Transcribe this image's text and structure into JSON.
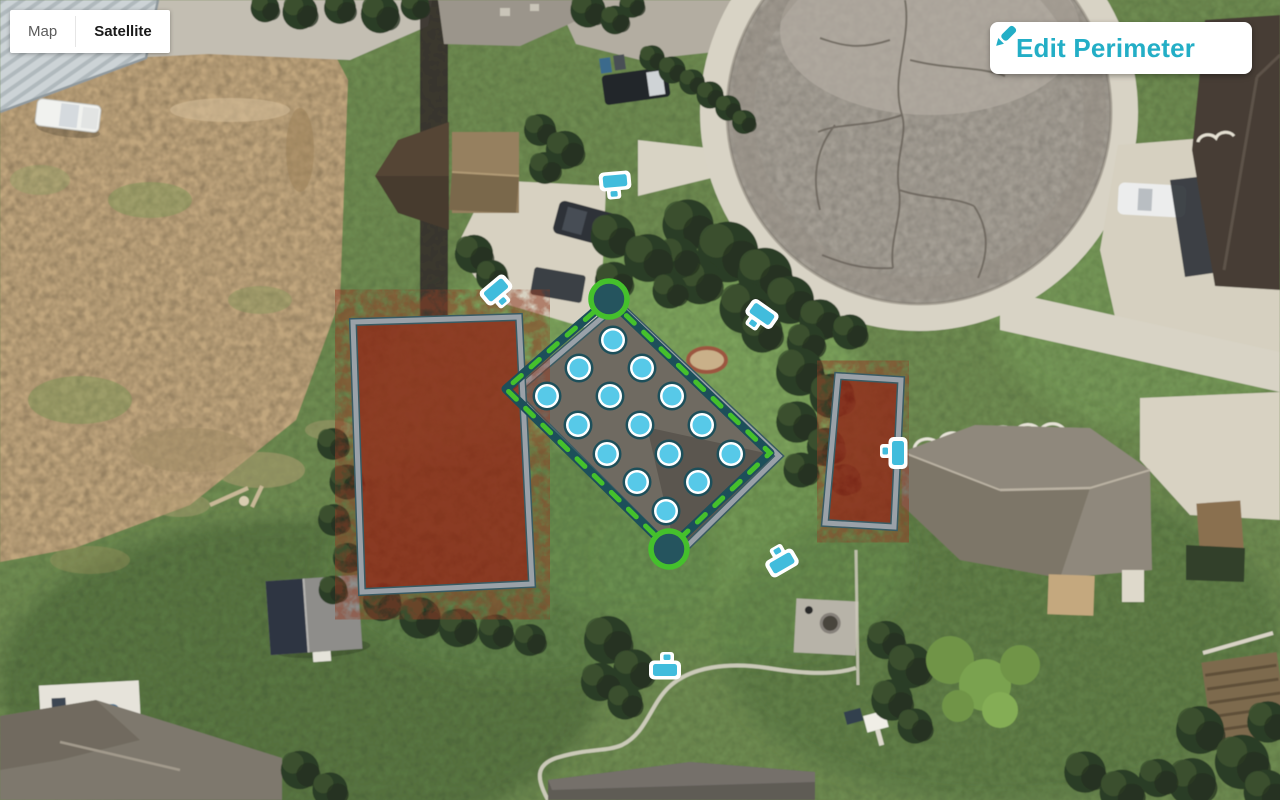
{
  "map_controls": {
    "map_label": "Map",
    "satellite_label": "Satellite",
    "selected": "Satellite"
  },
  "toolbar": {
    "edit_perimeter_label": "Edit Perimeter",
    "accent_color": "#23aec6"
  },
  "map_overlay": {
    "colors": {
      "casing": "#1d4f5a",
      "dash": "#45c02c",
      "marker_fill": "#25545e",
      "sprinkler": "#57c9e8",
      "sprinkler_ring": "#ffffff",
      "zone_border": "#9aa1a8",
      "zone_edge": "#3a5b63",
      "zone_fill": "#8e2415",
      "device": "#41bcdc",
      "roof_fill": "#6f6a61"
    },
    "perimeter": {
      "vertices": [
        [
          609,
          299
        ],
        [
          770,
          453
        ],
        [
          669,
          549
        ],
        [
          506,
          389
        ],
        [
          558,
          343
        ]
      ],
      "markers": [
        [
          609,
          299
        ],
        [
          669,
          549
        ]
      ]
    },
    "building_outline": [
      [
        618,
        304
      ],
      [
        779,
        456
      ],
      [
        677,
        556
      ],
      [
        514,
        393
      ]
    ],
    "zones": [
      {
        "id": "zone-red-left",
        "points": [
          [
            353,
            322
          ],
          [
            519,
            317
          ],
          [
            532,
            584
          ],
          [
            362,
            592
          ]
        ]
      },
      {
        "id": "zone-red-right",
        "points": [
          [
            838,
            376
          ],
          [
            901,
            380
          ],
          [
            894,
            527
          ],
          [
            825,
            523
          ]
        ]
      }
    ],
    "sprinklers": [
      [
        613,
        340
      ],
      [
        579,
        368
      ],
      [
        642,
        368
      ],
      [
        547,
        396
      ],
      [
        610,
        396
      ],
      [
        672,
        396
      ],
      [
        578,
        425
      ],
      [
        640,
        425
      ],
      [
        702,
        425
      ],
      [
        607,
        454
      ],
      [
        669,
        454
      ],
      [
        731,
        454
      ],
      [
        637,
        482
      ],
      [
        698,
        482
      ],
      [
        666,
        511
      ]
    ],
    "devices": [
      {
        "x": 615,
        "y": 181,
        "rot": -5
      },
      {
        "x": 496,
        "y": 290,
        "rot": -40
      },
      {
        "x": 762,
        "y": 314,
        "rot": 35
      },
      {
        "x": 898,
        "y": 453,
        "rot": 90
      },
      {
        "x": 782,
        "y": 563,
        "rot": 150
      },
      {
        "x": 665,
        "y": 670,
        "rot": 180
      }
    ]
  }
}
